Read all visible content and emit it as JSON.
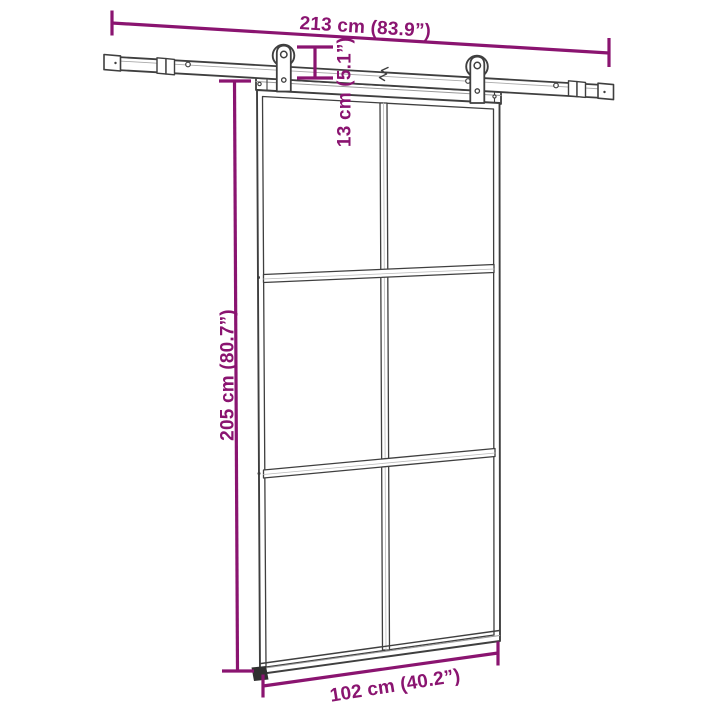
{
  "page": {
    "background": "#ffffff"
  },
  "diagram": {
    "subject": "sliding glass door with barn-style hardware kit",
    "accent_color": "#8a1470",
    "outline_color": "#3f3f3f",
    "door": {
      "glass_columns": 2,
      "glass_rows": 3
    },
    "dimensions": {
      "rail_length": {
        "label": "213 cm (83.9”)",
        "cm": 213,
        "in": 83.9
      },
      "hanger_drop": {
        "label": "13 cm (5.1”)",
        "cm": 13,
        "in": 5.1
      },
      "door_height": {
        "label": "205 cm (80.7”)",
        "cm": 205,
        "in": 80.7
      },
      "door_width": {
        "label": "102 cm (40.2”)",
        "cm": 102,
        "in": 40.2
      }
    }
  }
}
